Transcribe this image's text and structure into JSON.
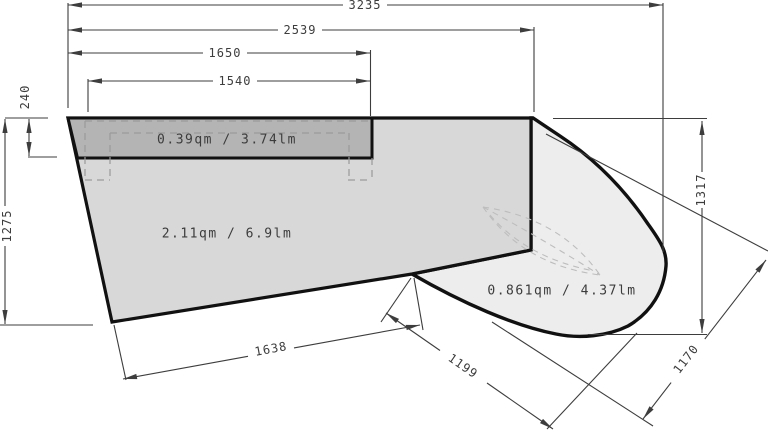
{
  "drawing": {
    "type": "countertop-measurement-plan",
    "dims": {
      "d3235": "3235",
      "d2539": "2539",
      "d1650": "1650",
      "d1540": "1540",
      "d240": "240",
      "d1275": "1275",
      "d1317": "1317",
      "d1638": "1638",
      "d1199": "1199",
      "d1170": "1170"
    },
    "areas": {
      "strip": "0.39qm / 3.74lm",
      "main": "2.11qm / 6.9lm",
      "corner": "0.861qm / 4.37lm"
    },
    "colors": {
      "outline": "#111111",
      "dimension_lines": "#3d3d3d",
      "fill_main": "#d8d8d8",
      "fill_strip": "#b4b4b4",
      "fill_corner": "#ededed",
      "dashed_construction": "#9a9a9a",
      "background": "#ffffff"
    }
  }
}
